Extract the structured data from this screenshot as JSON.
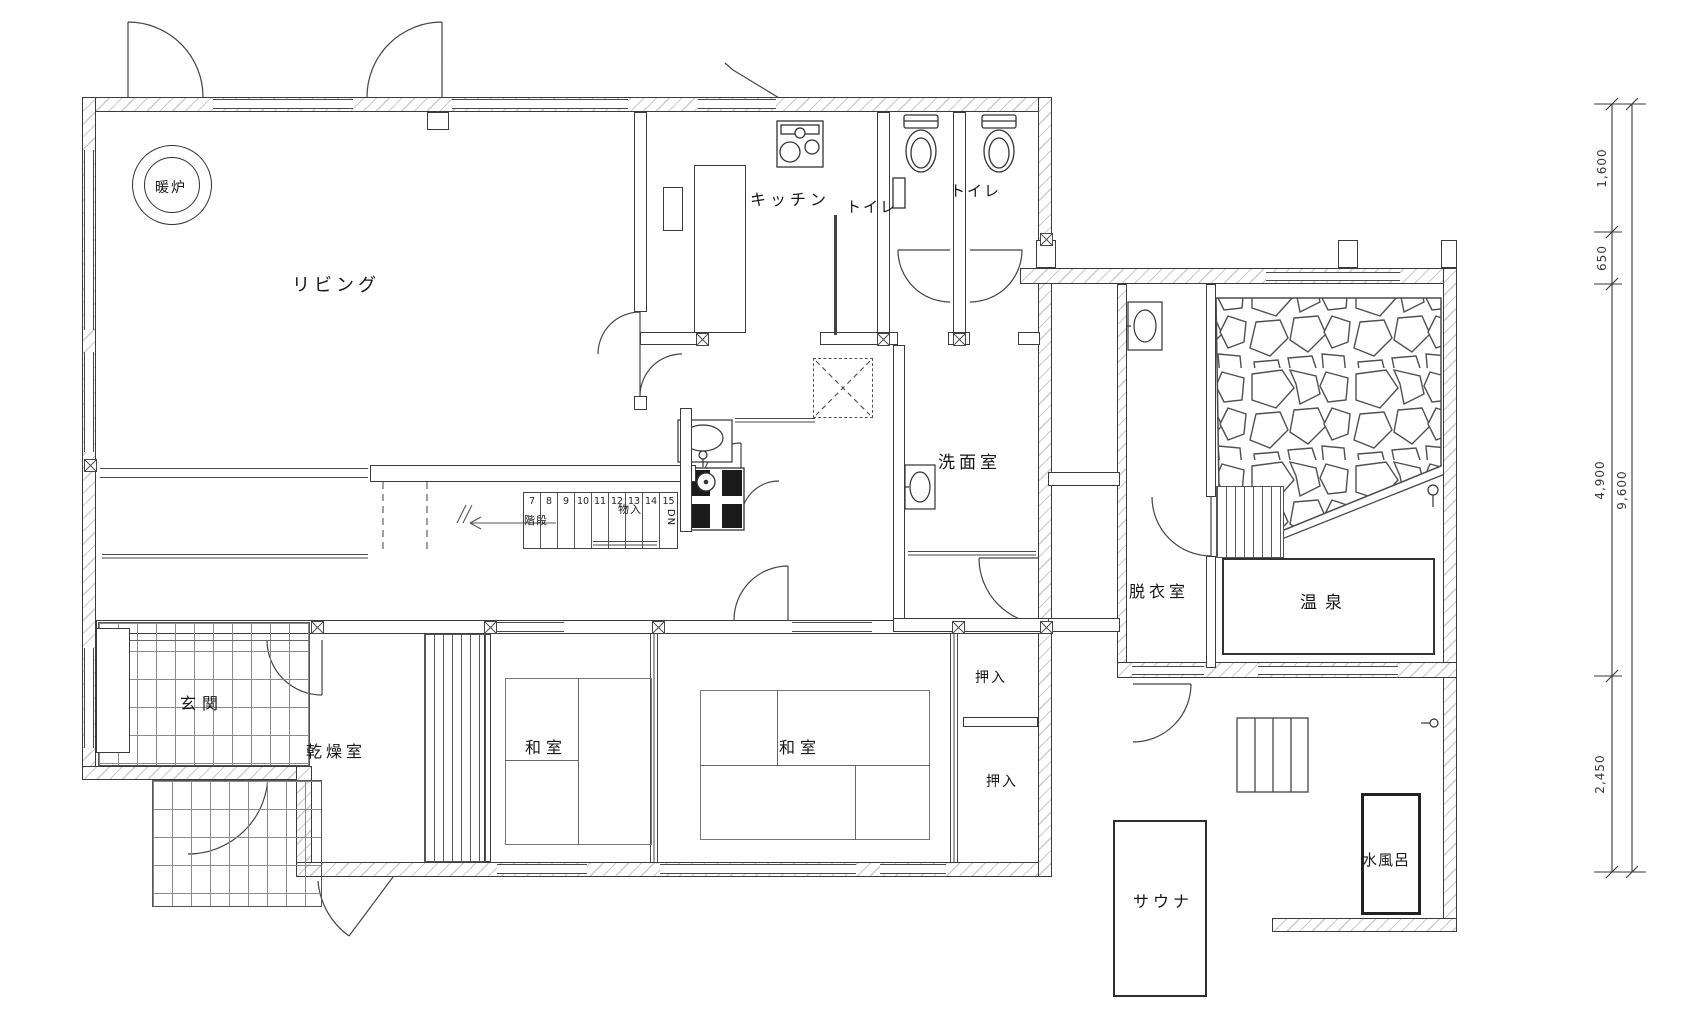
{
  "plan": {
    "rooms": {
      "living": "リビング",
      "fireplace": "暖炉",
      "kitchen": "キッチン",
      "toilet1": "トイレ",
      "toilet2": "トイレ",
      "washroom": "洗面室",
      "dressing_room": "脱衣室",
      "onsen": "温泉",
      "entrance": "玄関",
      "drying_room": "乾燥室",
      "tatami1": "和室",
      "tatami2": "和室",
      "closet_upper": "押入",
      "closet_lower": "押入",
      "storage": "物入",
      "stairs": "階段",
      "sauna": "サウナ",
      "cold_bath": "水風呂",
      "down_mark": "DN"
    },
    "stair_numbers": [
      "7",
      "8",
      "9",
      "10",
      "11",
      "12",
      "13",
      "14",
      "15"
    ],
    "dimensions": {
      "segments": [
        "1,600",
        "650",
        "4,900",
        "2,450"
      ],
      "overall": "9,600"
    }
  }
}
